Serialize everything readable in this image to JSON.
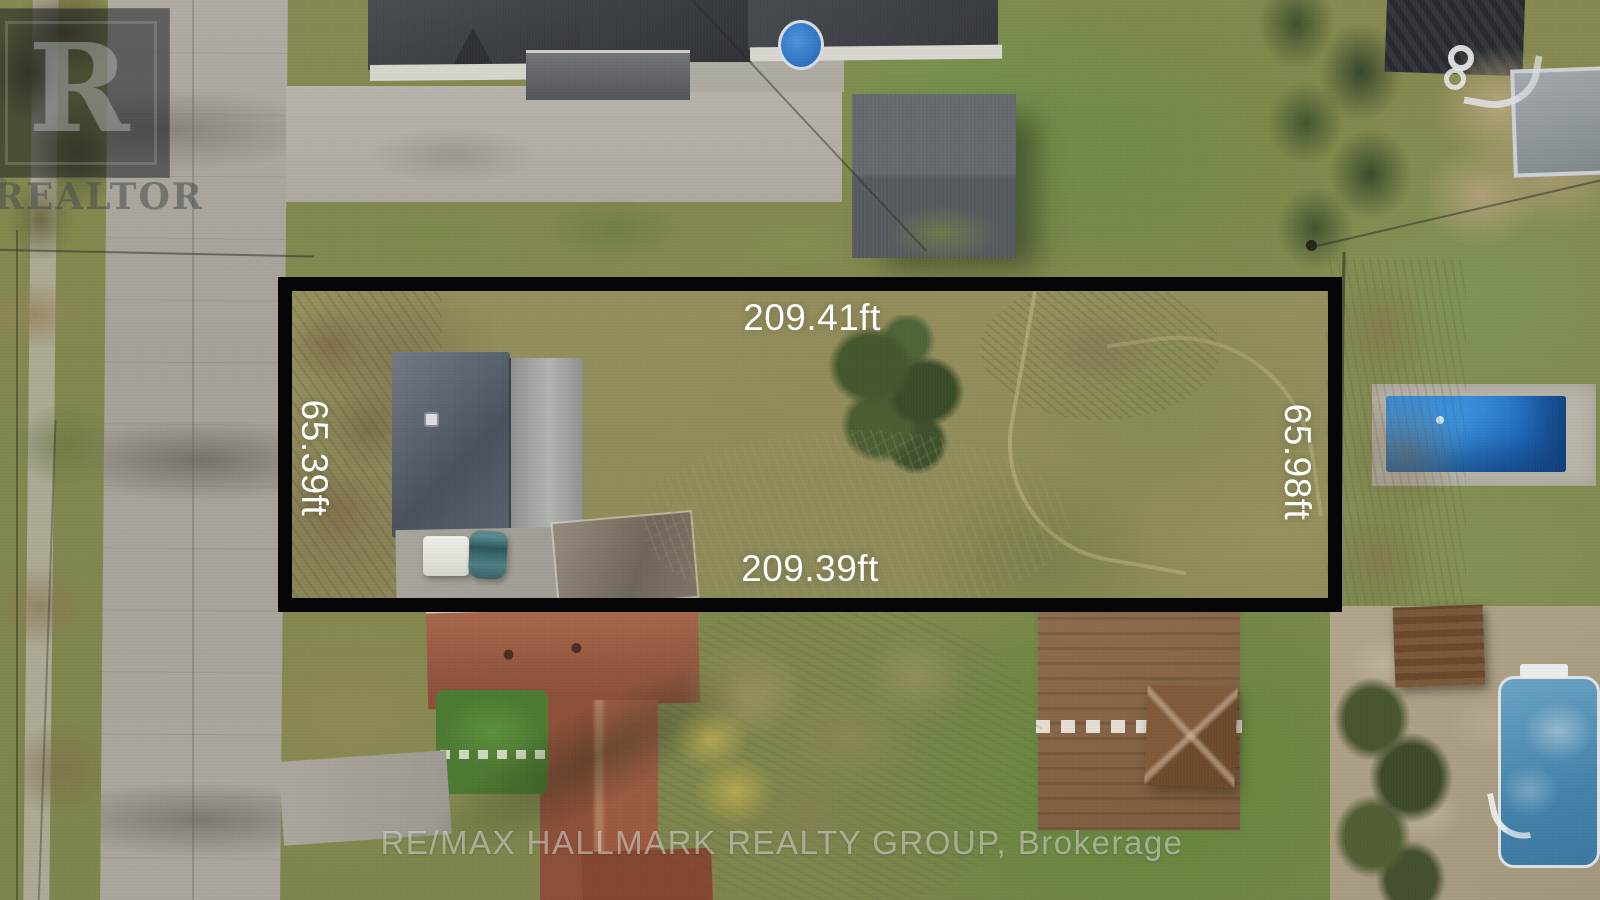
{
  "annotation": {
    "outline_color": "#000000",
    "label_color": "#ffffff",
    "dimensions": {
      "top": "209.41ft",
      "bottom": "209.39ft",
      "left": "65.39ft",
      "right": "65.98ft"
    }
  },
  "watermarks": {
    "realtor": {
      "letter": "R",
      "label": "REALTOR",
      "registered": "®"
    },
    "brokerage": "RE/MAX HALLMARK REALTY GROUP, Brokerage"
  },
  "scene": {
    "description": "Aerial drone photo of a residential lot outlined in black between a street and neighboring backyards",
    "colors": {
      "grass": "#7d8c52",
      "road": "#aaa69e",
      "pool_blue": "#2a7fd0",
      "roof_dark": "#43474b",
      "roof_red": "#9a5c41"
    }
  }
}
